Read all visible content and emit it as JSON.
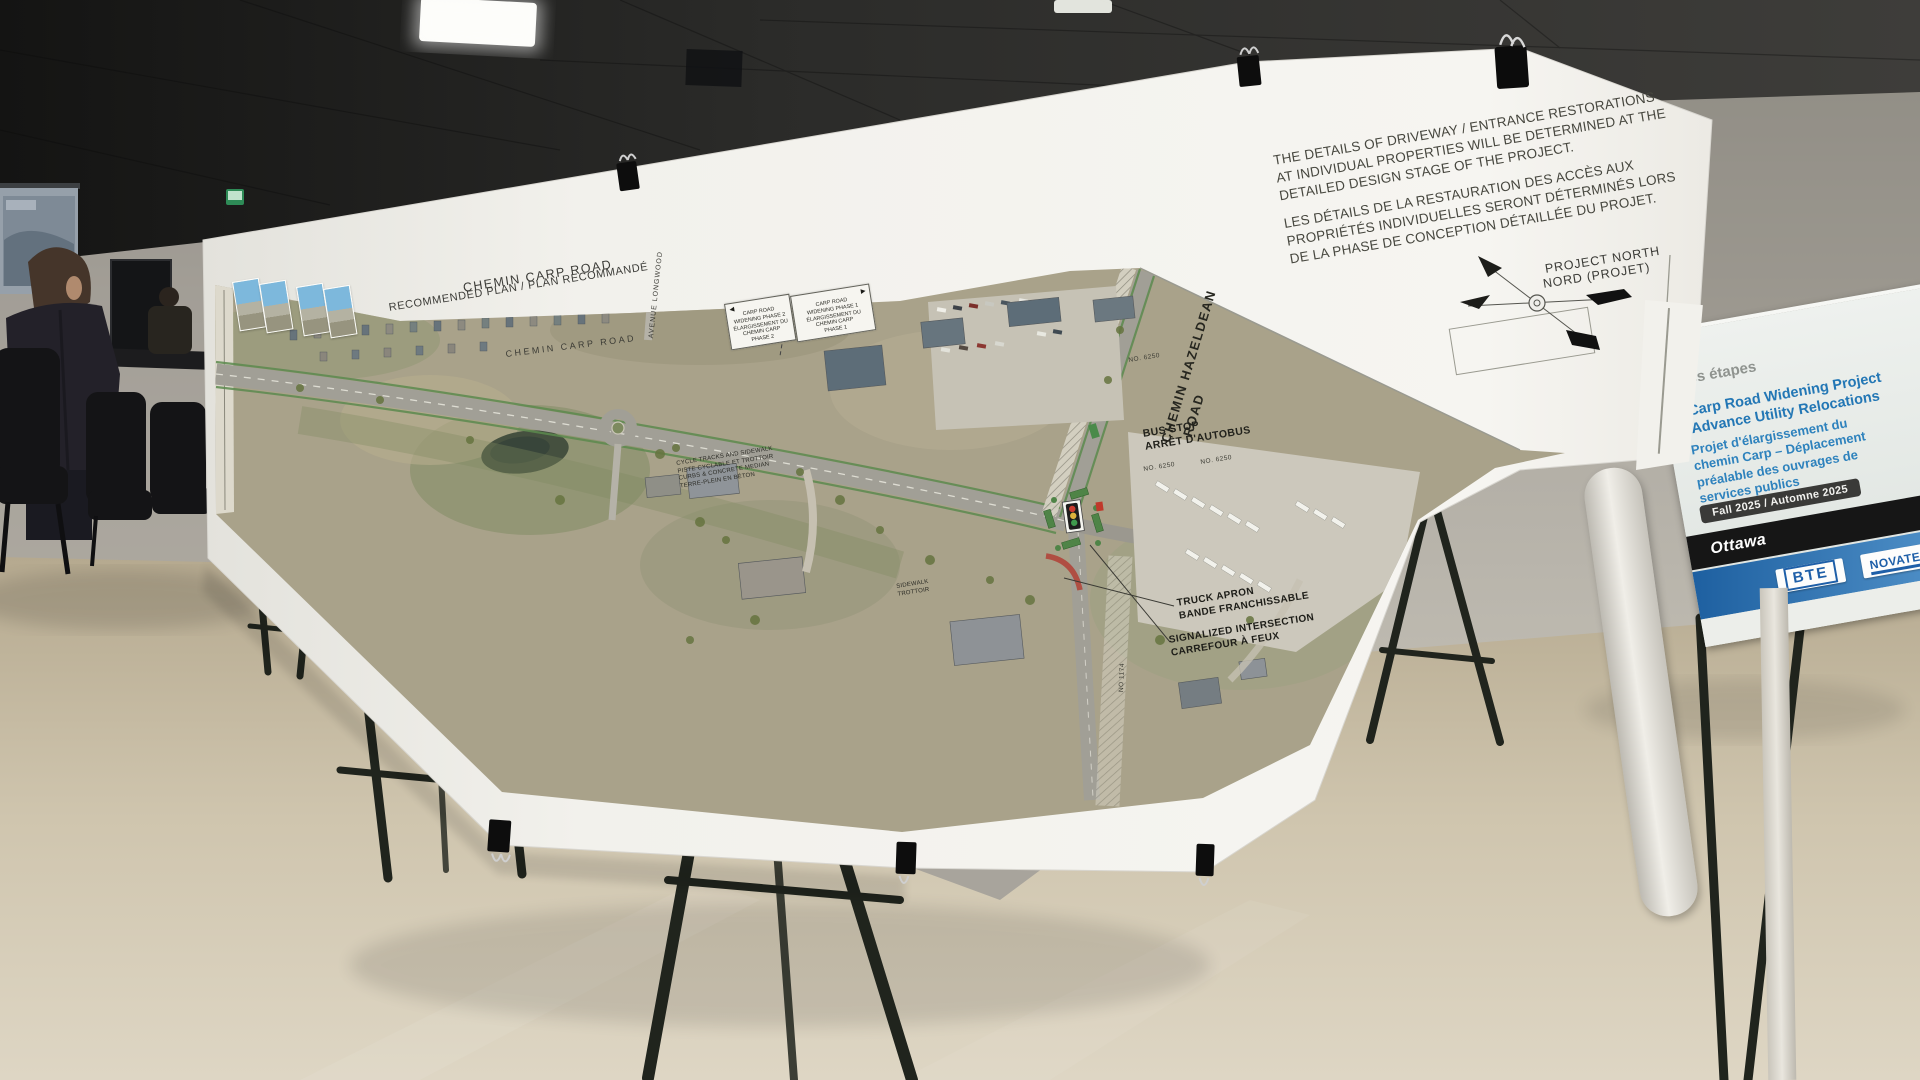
{
  "scene": {
    "room": {
      "wall_color": "#a8a49c",
      "ceiling_color": "#242422",
      "floor_color": "#cec3ac"
    },
    "people_count": 2
  },
  "poster": {
    "title_line1": "CHEMIN CARP ROAD",
    "title_line2": "RECOMMENDED PLAN / PLAN RECOMMANDÉ",
    "notice_en": [
      "THE DETAILS OF DRIVEWAY / ENTRANCE RESTORATIONS",
      "AT INDIVIDUAL PROPERTIES WILL BE DETERMINED AT THE",
      "DETAILED DESIGN STAGE OF THE PROJECT."
    ],
    "notice_fr": [
      "LES DÉTAILS DE LA RESTAURATION DES ACCÈS AUX",
      "PROPRIÉTÉS INDIVIDUELLES SERONT DÉTERMINÉS LORS",
      "DE LA PHASE DE CONCEPTION DÉTAILLÉE DU PROJET."
    ],
    "compass": {
      "line1": "PROJECT NORTH",
      "line2": "NORD (PROJET)"
    },
    "map": {
      "street_carp": "CHEMIN CARP ROAD",
      "street_longwood": "AVENUE LONGWOOD",
      "hazeldean_line1": "CHEMIN HAZELDEAN",
      "hazeldean_line2": "ROAD",
      "bus_stop_en": "BUS STOP",
      "bus_stop_fr": "ARRÊT D'AUTOBUS",
      "truck_apron_en": "TRUCK APRON",
      "truck_apron_fr": "BANDE FRANCHISSABLE",
      "signalized_en": "SIGNALIZED INTERSECTION",
      "signalized_fr": "CARREFOUR À FEUX",
      "cycle_note": [
        "CYCLE TRACKS AND SIDEWALK",
        "PISTE CYCLABLE ET TROTTOIR",
        "CURBS & CONCRETE MEDIAN",
        "TERRE-PLEIN EN BÉTON"
      ],
      "sidewalk_note": [
        "SIDEWALK",
        "TROTTOIR"
      ],
      "parcels": [
        "NO. 6250",
        "NO. 6250",
        "NO. 6250",
        "NO 1174"
      ],
      "phase_box_west": [
        "CARP ROAD",
        "WIDENING PHASE 2",
        "ÉLARGISSEMENT DU",
        "CHEMIN CARP",
        "PHASE 2"
      ],
      "phase_box_east": [
        "CARP ROAD",
        "WIDENING PHASE 1",
        "ÉLARGISSEMENT DU",
        "CHEMIN CARP",
        "PHASE 1"
      ],
      "arrow_west": "◄",
      "arrow_east": "►"
    }
  },
  "side_board": {
    "heading_fragment": "es étapes",
    "en_line1": "Carp Road Widening Project",
    "en_line2": "Advance Utility Relocations",
    "fr_line1": "Projet d'élargissement du",
    "fr_line2": "chemin Carp – Déplacement",
    "fr_line3": "préalable des ouvrages de",
    "fr_line4": "services publics",
    "date_pill": "Fall 2025 / Automne 2025",
    "city_logo": "Ottawa",
    "logo_bte": "BTE",
    "logo_novatech": "NOVATECH"
  },
  "colors": {
    "paper": "#f2f1ec",
    "map_base": "#a9a28a",
    "board_blue_text": "#2377b5",
    "logo_blue": "#1e5fa8",
    "pill_bg": "#3a3a38",
    "signal_red": "#cc3b2f",
    "signal_yellow": "#ddb33c",
    "signal_green": "#3f9a4d"
  }
}
